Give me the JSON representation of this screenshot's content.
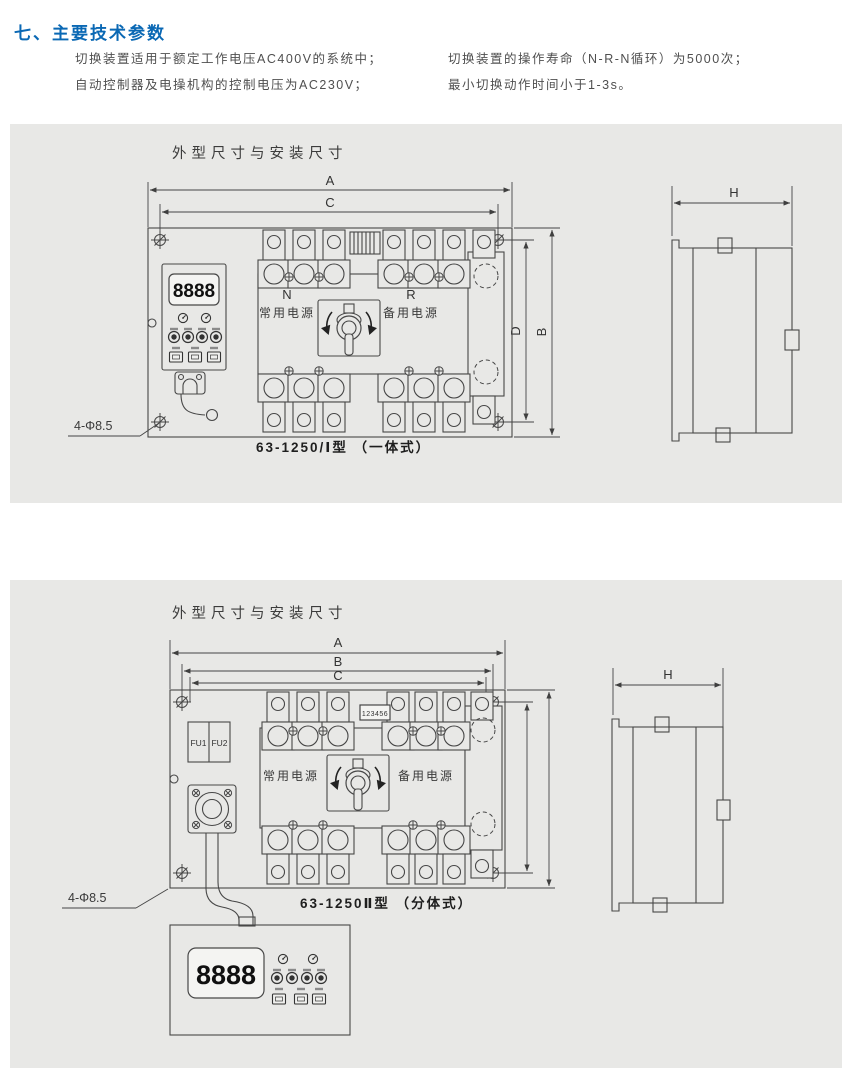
{
  "page": {
    "heading": "七、主要技术参数",
    "intro_left": [
      "切换装置适用于额定工作电压AC400V的系统中；",
      "自动控制器及电操机构的控制电压为AC230V；"
    ],
    "intro_right": [
      "切换装置的操作寿命（N-R-N循环）为5000次；",
      "最小切换动作时间小于1-3s。"
    ]
  },
  "panel1": {
    "title": "外型尺寸与安装尺寸",
    "caption": "63-1250/Ⅰ型 （一体式）",
    "hole_note": "4-Φ8.5",
    "display": "8888",
    "labels": {
      "n": "N",
      "normal_power": "常用电源",
      "r": "R",
      "backup_power": "备用电源"
    },
    "dims": {
      "a": "A",
      "c": "C",
      "d": "D",
      "b": "B",
      "h": "H"
    }
  },
  "panel2": {
    "title": "外型尺寸与安装尺寸",
    "caption": "63-1250Ⅱ型 （分体式）",
    "hole_note": "4-Φ8.5",
    "display": "8888",
    "labels": {
      "normal_power": "常用电源",
      "backup_power": "备用电源",
      "fu1": "FU1",
      "fu2": "FU2",
      "terminal_block": "123456"
    },
    "dims": {
      "a": "A",
      "b": "B",
      "c": "C",
      "h": "H"
    }
  },
  "colors": {
    "heading_blue": "#0a68b4",
    "panel_gray": "#e8e8e6",
    "line": "#474747"
  }
}
